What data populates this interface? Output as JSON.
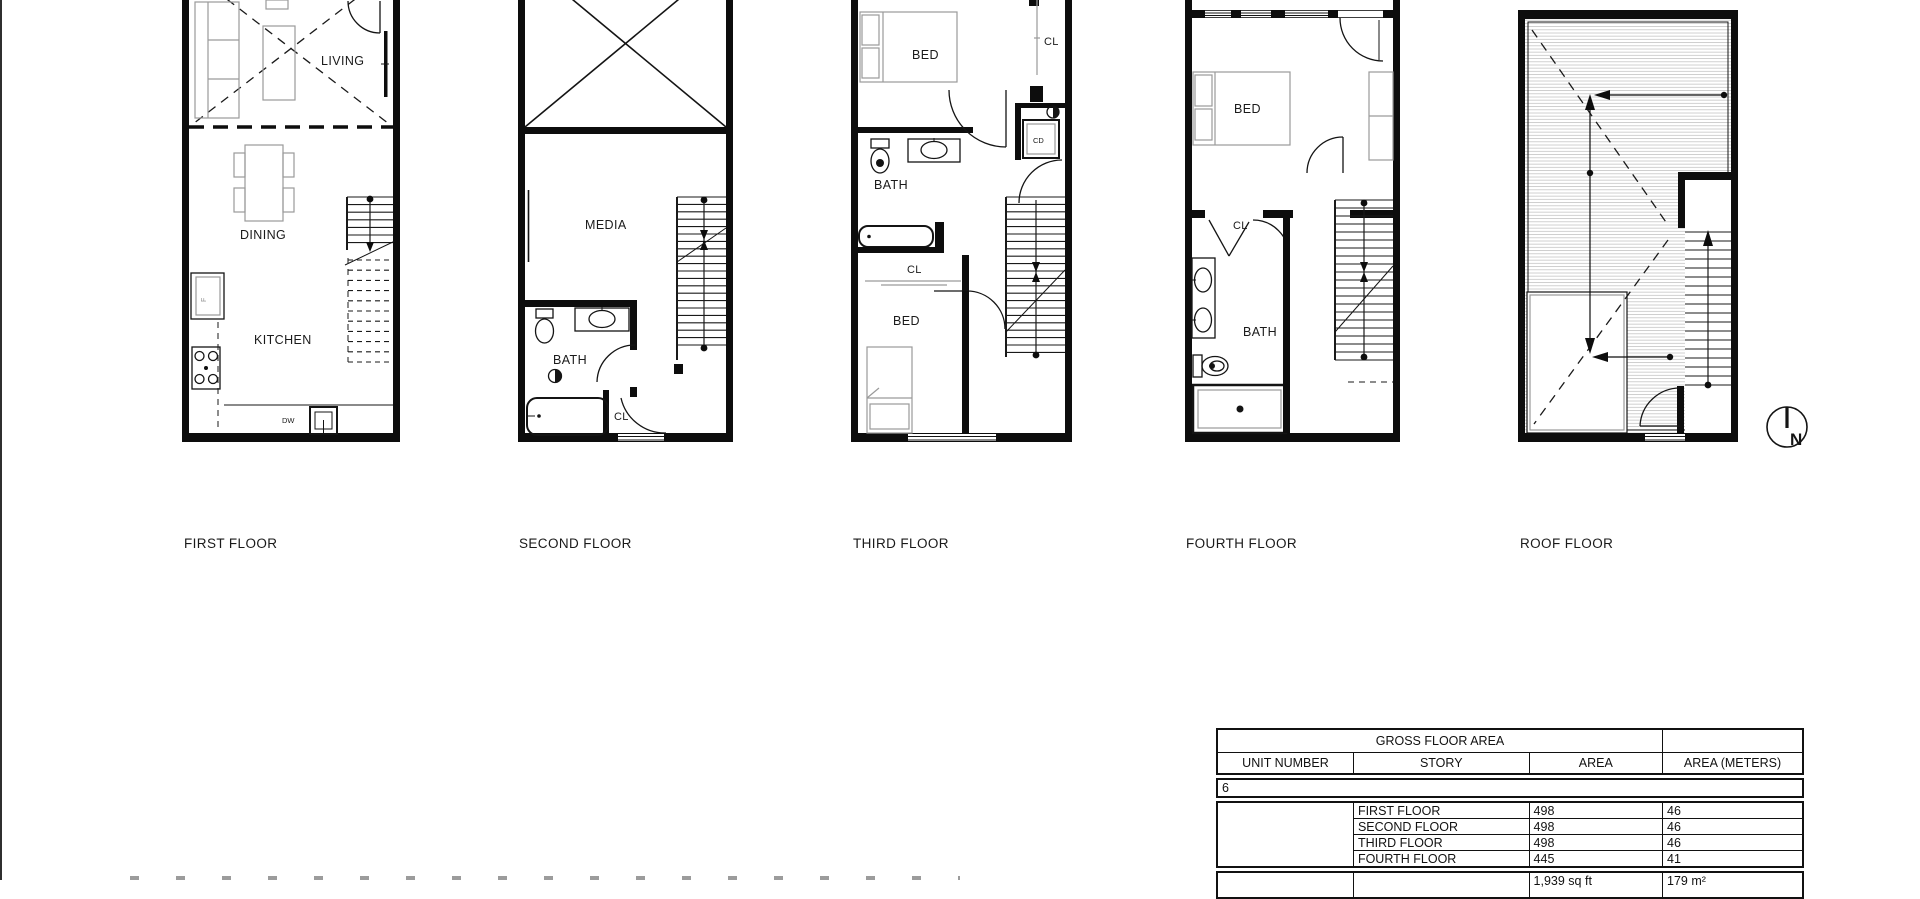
{
  "floor_plans": [
    {
      "id": "first",
      "label": "FIRST FLOOR",
      "rooms": {
        "living": "LIVING",
        "dining": "DINING",
        "kitchen": "KITCHEN",
        "dishwasher": "DW",
        "fridge": "F"
      }
    },
    {
      "id": "second",
      "label": "SECOND FLOOR",
      "rooms": {
        "media": "MEDIA",
        "bath": "BATH",
        "closet": "CL"
      }
    },
    {
      "id": "third",
      "label": "THIRD FLOOR",
      "rooms": {
        "bed_top": "BED",
        "closet_top": "CL",
        "bath": "BATH",
        "combo_dryer": "CD",
        "closet_mid": "CL",
        "bed_bottom": "BED"
      }
    },
    {
      "id": "fourth",
      "label": "FOURTH FLOOR",
      "rooms": {
        "bed": "BED",
        "closet": "CL",
        "bath": "BATH"
      }
    },
    {
      "id": "roof",
      "label": "ROOF FLOOR",
      "rooms": {}
    }
  ],
  "compass": {
    "letter": "N"
  },
  "area_table": {
    "title": "GROSS FLOOR AREA",
    "headers": [
      "UNIT NUMBER",
      "STORY",
      "AREA",
      "AREA (METERS)"
    ],
    "unit_number": "6",
    "rows": [
      {
        "story": "FIRST FLOOR",
        "area": "498",
        "area_meters": "46"
      },
      {
        "story": "SECOND FLOOR",
        "area": "498",
        "area_meters": "46"
      },
      {
        "story": "THIRD FLOOR",
        "area": "498",
        "area_meters": "46"
      },
      {
        "story": "FOURTH FLOOR",
        "area": "445",
        "area_meters": "41"
      }
    ],
    "total": {
      "area": "1,939 sq ft",
      "area_meters": "179 m²"
    }
  }
}
